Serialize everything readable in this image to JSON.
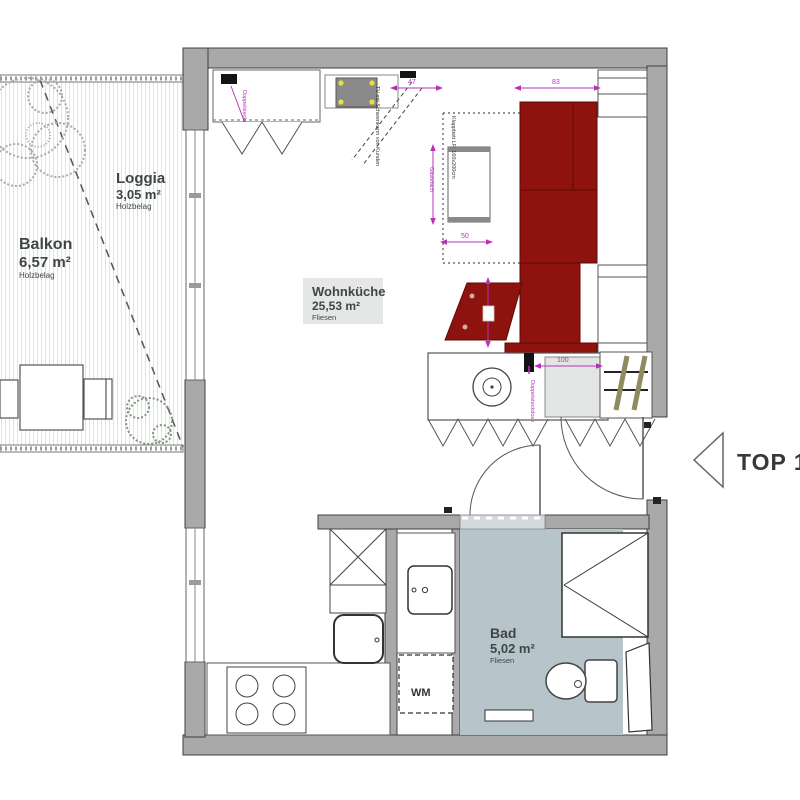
{
  "areas": {
    "balkon": {
      "name": "Balkon",
      "size": "6,57 m²",
      "floor": "Holzbelag"
    },
    "loggia": {
      "name": "Loggia",
      "size": "3,05 m²",
      "floor": "Holzbelag"
    },
    "wohnkueche": {
      "name": "Wohnküche",
      "size": "25,53 m²",
      "floor": "Fliesen"
    },
    "bad": {
      "name": "Bad",
      "size": "5,02 m²",
      "floor": "Fliesen"
    }
  },
  "unit": {
    "label": "TOP 14"
  },
  "appliances": {
    "wm": "WM"
  },
  "annotations": {
    "tv": "TV mit Schwenkarm von Kunden",
    "klappbett": "Klappbett LF: 160x200cm",
    "gaestefach": "Gästefach",
    "doppelsteckdose": "Doppelsteckdose"
  },
  "dimensions": {
    "d47": "47",
    "d83": "83",
    "d50": "50",
    "d100": "100"
  },
  "colors": {
    "wall": "#a9a9a9",
    "outline": "#3f3f3f",
    "couch_red": "#8e120e",
    "couch_line": "#5e0a07",
    "bath_floor": "#b7c4c9",
    "threshold": "#d4dadb",
    "dimension_magenta": "#b832b8",
    "ladder_wood": "#8f8a60",
    "hood_gray": "#8a8a8a",
    "hood_dot_yellow": "#e6e23e",
    "label_box": "#e5e7e7",
    "text_dark": "#3f4648"
  }
}
